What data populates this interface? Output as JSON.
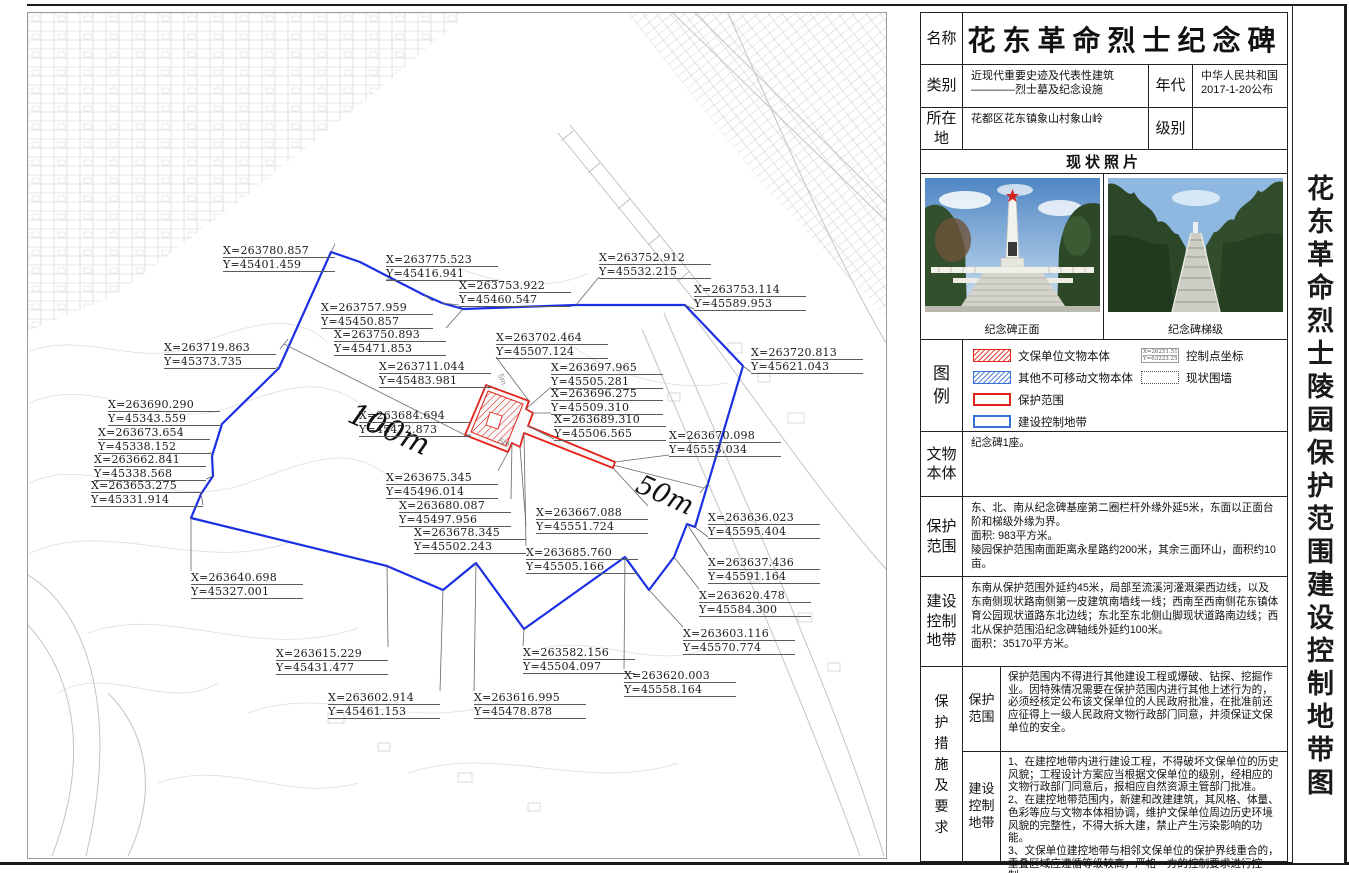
{
  "title_panel": {
    "text": "花东革命烈士陵园保护范围建设控制地带图"
  },
  "info_table": {
    "name_label": "名称",
    "name_value": "花东革命烈士纪念碑",
    "category_label": "类别",
    "category_value": "近现代重要史迹及代表性建筑\n————烈士墓及纪念设施",
    "era_label": "年代",
    "era_value": "中华人民共和国\n2017-1-20公布",
    "location_label": "所在\n地",
    "location_value": "花都区花东镇象山村象山岭",
    "level_label": "级别",
    "level_value": ""
  },
  "photos": {
    "header": "现状照片",
    "left_caption": "纪念碑正面",
    "right_caption": "纪念碑梯级"
  },
  "legend": {
    "label": "图\n例",
    "items": [
      {
        "text": "文保单位文物本体"
      },
      {
        "text": "其他不可移动文物本体"
      },
      {
        "text": "保护范围"
      },
      {
        "text": "建设控制地带"
      },
      {
        "text": "控制点坐标",
        "sample_x": "X=26251.511",
        "sample_y": "Y=63223.251"
      },
      {
        "text": "现状围墙"
      }
    ]
  },
  "relic": {
    "label": "文物\n本体",
    "text": "纪念碑1座。"
  },
  "scope": {
    "label": "保护\n范围",
    "text": "东、北、南从纪念碑基座第二圈栏杆外缘外延5米，东面以正面台阶和梯级外缘为界。\n面积: 983平方米。\n陵园保护范围南面距离永星路约200米，其余三面环山，面积约10亩。"
  },
  "zone": {
    "label": "建设\n控制\n地带",
    "text": "东南从保护范围外延约45米，局部至流溪河灌溉渠西边线，以及东南侧现状路南侧第一皮建筑南墙线一线；西南至西南侧花东镇体育公园现状道路东北边线；东北至东北侧山脚现状道路南边线；西北从保护范围沿纪念碑轴线外延约100米。\n面积：35170平方米。"
  },
  "measures": {
    "label": "保\n护\n措\n施\n及\n要\n求",
    "scope_label": "保护\n范围",
    "scope_text": "保护范围内不得进行其他建设工程或爆破、钻探、挖掘作业。因特殊情况需要在保护范围内进行其他上述行为的，必须经核定公布该文保单位的人民政府批准，在批准前还应征得上一级人民政府文物行政部门同意，并须保证文保单位的安全。",
    "zone_label": "建设\n控制\n地带",
    "zone_text": "1、在建控地带内进行建设工程，不得破坏文保单位的历史风貌；工程设计方案应当根据文保单位的级别，经相应的文物行政部门同意后，报相应自然资源主管部门批准。\n2、在建控地带范围内，新建和改建建筑，其风格、体量、色彩等应与文物本体相协调，维护文保单位周边历史环境风貌的完整性，不得大拆大建，禁止产生污染影响的功能。\n3、文保单位建控地带与相邻文保单位的保护界线重合的，重叠区域应遵循等级较高，严格一方的控制要求进行控制。"
  },
  "map": {
    "colors": {
      "blue": "#1b2fe3",
      "red": "#e3241d"
    },
    "blue_polygon": "303,239 332,249 396,282 414,290 435,296 548,292 657,292 715,353 667,514 659,511 646,544 621,577 597,544 496,616 448,550 415,577 359,553 163,505 173,481 185,463 184,443 194,411 251,355",
    "red_outline": "458,372 501,388 498,396 505,400 500,413 587,449 585,455 496,420 492,434 484,430 480,439 437,422",
    "red_inner_hatch": "460,378 495,391 478,433 443,419",
    "monument_center": "462,399 474,403 470,416 458,412",
    "dim_lines": [
      {
        "text": "100m",
        "x1": 256,
        "y1": 331,
        "x2": 437,
        "y2": 422,
        "tick": "start",
        "tx": 318,
        "ty": 408,
        "rot": 24,
        "size": 30
      },
      {
        "text": "50m",
        "x1": 585,
        "y1": 452,
        "x2": 676,
        "y2": 475,
        "tick": "end",
        "tx": 606,
        "ty": 478,
        "rot": 24,
        "size": 27
      }
    ],
    "small_labels": [
      {
        "text": "5m",
        "x": 470,
        "y": 362,
        "rot": 70
      },
      {
        "text": "5m",
        "x": 470,
        "y": 430,
        "rot": 20
      }
    ],
    "control_points": [
      {
        "x_label": "X=263780.857",
        "y_label": "Y=45401.459",
        "lx": 195,
        "ly": 231,
        "tx": 303,
        "ty": 239
      },
      {
        "x_label": "X=263775.523",
        "y_label": "Y=45416.941",
        "lx": 358,
        "ly": 240,
        "tx": 372,
        "ty": 268
      },
      {
        "x_label": "X=263753.922",
        "y_label": "Y=45460.547",
        "lx": 431,
        "ly": 266,
        "tx": 414,
        "ty": 290
      },
      {
        "x_label": "X=263757.959",
        "y_label": "Y=45450.857",
        "lx": 293,
        "ly": 288,
        "tx": 396,
        "ty": 282
      },
      {
        "x_label": "X=263750.893",
        "y_label": "Y=45471.853",
        "lx": 306,
        "ly": 315,
        "tx": 435,
        "ty": 296
      },
      {
        "x_label": "X=263752.912",
        "y_label": "Y=45532.215",
        "lx": 571,
        "ly": 238,
        "tx": 548,
        "ty": 292
      },
      {
        "x_label": "X=263753.114",
        "y_label": "Y=45589.953",
        "lx": 666,
        "ly": 270,
        "tx": 657,
        "ty": 292
      },
      {
        "x_label": "X=263720.813",
        "y_label": "Y=45621.043",
        "lx": 723,
        "ly": 333,
        "tx": 715,
        "ty": 353
      },
      {
        "x_label": "X=263719.863",
        "y_label": "Y=45373.735",
        "lx": 136,
        "ly": 328,
        "tx": 251,
        "ty": 355
      },
      {
        "x_label": "X=263711.044",
        "y_label": "Y=45483.981",
        "lx": 351,
        "ly": 347,
        "tx": 458,
        "ty": 372
      },
      {
        "x_label": "X=263702.464",
        "y_label": "Y=45507.124",
        "lx": 468,
        "ly": 318,
        "tx": 501,
        "ty": 388
      },
      {
        "x_label": "X=263697.965",
        "y_label": "Y=45505.281",
        "lx": 523,
        "ly": 348,
        "tx": 498,
        "ty": 396
      },
      {
        "x_label": "X=263696.275",
        "y_label": "Y=45509.310",
        "lx": 523,
        "ly": 374,
        "tx": 505,
        "ty": 400
      },
      {
        "x_label": "X=263689.310",
        "y_label": "Y=45506.565",
        "lx": 526,
        "ly": 400,
        "tx": 500,
        "ty": 413
      },
      {
        "x_label": "X=263690.290",
        "y_label": "Y=45343.559",
        "lx": 80,
        "ly": 385,
        "tx": 194,
        "ty": 411
      },
      {
        "x_label": "X=263673.654",
        "y_label": "Y=45338.152",
        "lx": 70,
        "ly": 413,
        "tx": 184,
        "ty": 443
      },
      {
        "x_label": "X=263662.841",
        "y_label": "Y=45338.568",
        "lx": 66,
        "ly": 440,
        "tx": 185,
        "ty": 463
      },
      {
        "x_label": "X=263653.275",
        "y_label": "Y=45331.914",
        "lx": 63,
        "ly": 466,
        "tx": 173,
        "ty": 481
      },
      {
        "x_label": "X=263684.694",
        "y_label": "Y=45472.873",
        "lx": 331,
        "ly": 396,
        "tx": 437,
        "ty": 422
      },
      {
        "x_label": "X=263675.345",
        "y_label": "Y=45496.014",
        "lx": 358,
        "ly": 458,
        "tx": 480,
        "ty": 439
      },
      {
        "x_label": "X=263680.087",
        "y_label": "Y=45497.956",
        "lx": 371,
        "ly": 486,
        "tx": 484,
        "ty": 430
      },
      {
        "x_label": "X=263678.345",
        "y_label": "Y=45502.243",
        "lx": 386,
        "ly": 513,
        "tx": 492,
        "ty": 434
      },
      {
        "x_label": "X=263667.088",
        "y_label": "Y=45551.724",
        "lx": 508,
        "ly": 493,
        "tx": 585,
        "ty": 455
      },
      {
        "x_label": "X=263685.760",
        "y_label": "Y=45505.166",
        "lx": 498,
        "ly": 533,
        "tx": 496,
        "ty": 420
      },
      {
        "x_label": "X=263670.098",
        "y_label": "Y=45553.034",
        "lx": 641,
        "ly": 416,
        "tx": 587,
        "ty": 449
      },
      {
        "x_label": "X=263636.023",
        "y_label": "Y=45595.404",
        "lx": 680,
        "ly": 498,
        "tx": 667,
        "ty": 514
      },
      {
        "x_label": "X=263637.436",
        "y_label": "Y=45591.164",
        "lx": 680,
        "ly": 543,
        "tx": 659,
        "ty": 511
      },
      {
        "x_label": "X=263620.478",
        "y_label": "Y=45584.300",
        "lx": 671,
        "ly": 576,
        "tx": 646,
        "ty": 544
      },
      {
        "x_label": "X=263603.116",
        "y_label": "Y=45570.774",
        "lx": 655,
        "ly": 614,
        "tx": 621,
        "ty": 577
      },
      {
        "x_label": "X=263640.698",
        "y_label": "Y=45327.001",
        "lx": 163,
        "ly": 558,
        "tx": 163,
        "ty": 505
      },
      {
        "x_label": "X=263615.229",
        "y_label": "Y=45431.477",
        "lx": 248,
        "ly": 634,
        "tx": 359,
        "ty": 553
      },
      {
        "x_label": "X=263602.914",
        "y_label": "Y=45461.153",
        "lx": 300,
        "ly": 678,
        "tx": 415,
        "ty": 577
      },
      {
        "x_label": "X=263616.995",
        "y_label": "Y=45478.878",
        "lx": 446,
        "ly": 678,
        "tx": 448,
        "ty": 550
      },
      {
        "x_label": "X=263582.156",
        "y_label": "Y=45504.097",
        "lx": 495,
        "ly": 633,
        "tx": 496,
        "ty": 616
      },
      {
        "x_label": "X=263620.003",
        "y_label": "Y=45558.164",
        "lx": 596,
        "ly": 656,
        "tx": 597,
        "ty": 544
      }
    ]
  }
}
